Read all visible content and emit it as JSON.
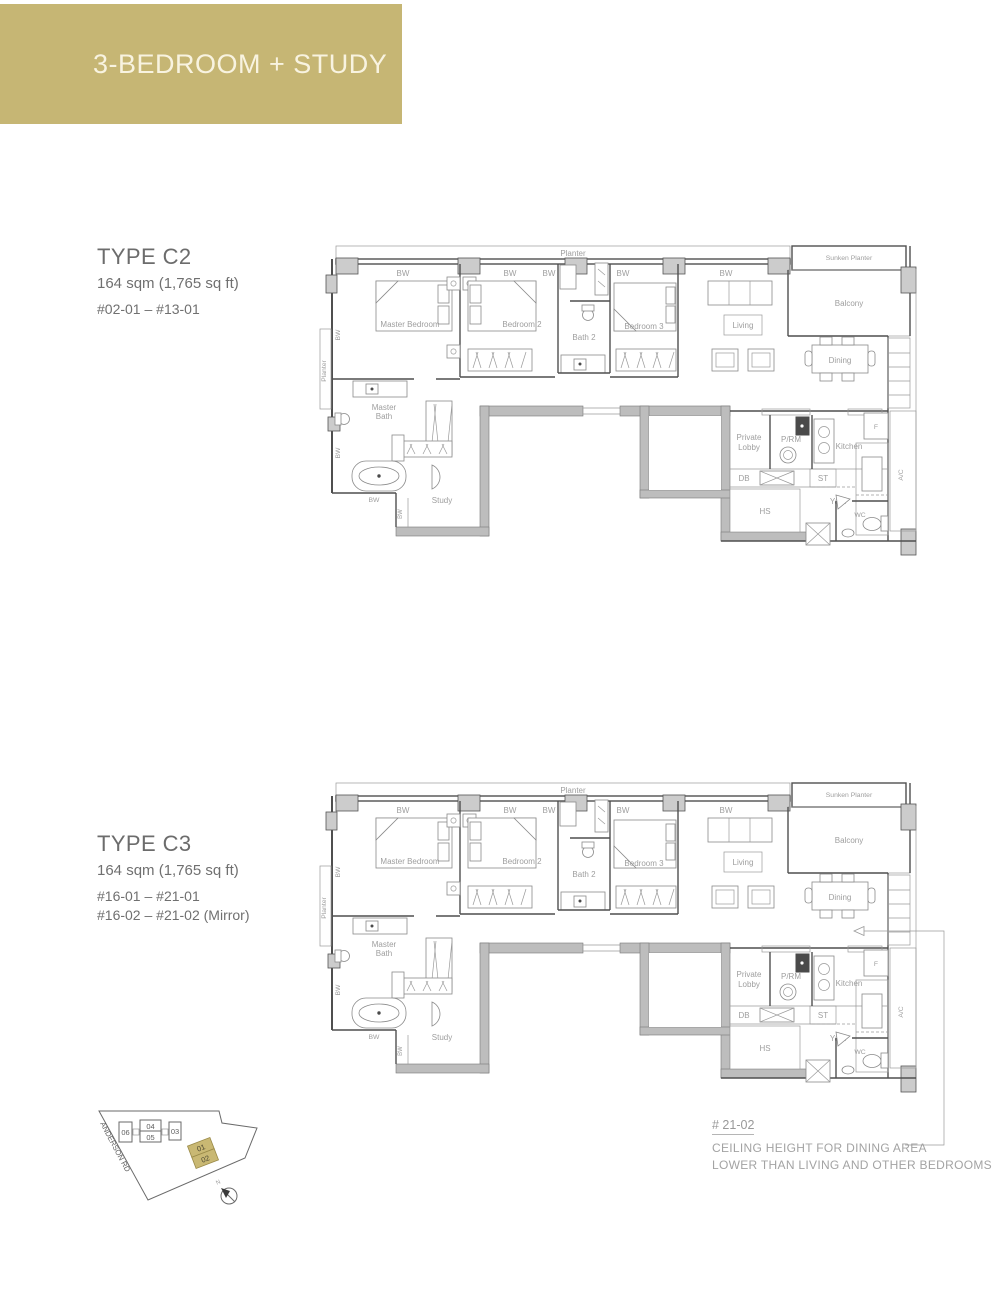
{
  "banner": {
    "title": "3-BEDROOM + STUDY",
    "bg_color": "#c6b674",
    "text_color": "#f8f3e0"
  },
  "types": [
    {
      "name": "TYPE C2",
      "area": "164 sqm (1,765 sq ft)",
      "units": [
        "#02-01 – #13-01"
      ]
    },
    {
      "name": "TYPE C3",
      "area": "164 sqm (1,765 sq ft)",
      "units": [
        "#16-01 – #21-01",
        "#16-02 – #21-02 (Mirror)"
      ]
    }
  ],
  "plan_labels": {
    "planter_top": "Planter",
    "planter_left": "Planter",
    "bw": "BW",
    "sunken_planter": "Sunken Planter",
    "balcony": "Balcony",
    "master_bedroom": "Master Bedroom",
    "bedroom_2": "Bedroom 2",
    "bedroom_3": "Bedroom 3",
    "bath_2": "Bath 2",
    "living": "Living",
    "dining": "Dining",
    "master_bath": "Master Bath",
    "study": "Study",
    "private_lobby": "Private Lobby",
    "p_rm": "P/RM",
    "kitchen": "Kitchen",
    "fridge": "F",
    "db": "DB",
    "st": "ST",
    "hs": "HS",
    "yard": "Yard",
    "wc": "WC",
    "ac": "A/C"
  },
  "key_plan": {
    "road": "ANDERSON RD",
    "north": "N",
    "units_white": [
      "06",
      "04",
      "05",
      "03"
    ],
    "units_highlighted": [
      "01",
      "02"
    ],
    "highlight_color": "#c9b873"
  },
  "note": {
    "unit": "# 21-02",
    "line1": "CEILING HEIGHT FOR DINING AREA",
    "line2": "LOWER THAN LIVING AND OTHER BEDROOMS"
  }
}
